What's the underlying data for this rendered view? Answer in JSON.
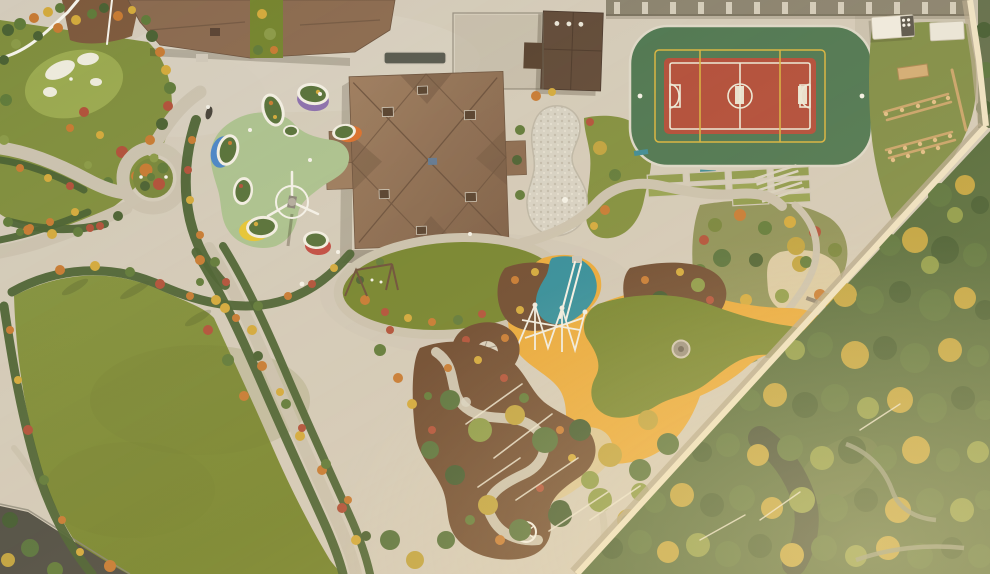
{
  "meta": {
    "domain": "natural-image",
    "title": "Autumn aerial drone view of a landscaped residential estate with playgrounds, sports court, lawns and surrounding pine forest",
    "view": "top-down aerial photograph",
    "season": "autumn"
  },
  "scene": {
    "main_house": "large residence with brown hipped roof, multiple chimneys, skylight and rear bay window",
    "outbuildings": [
      "garage / service wing along the top edge",
      "pool house with dark brown roof beside the sports court"
    ],
    "sports_court": "green multi-sport court with red centre field, white football markings, yellow overlay lines and colonnade wall above",
    "toddler_playground": "sage-green rubber surface with white-rimmed planter islands (purple, orange, blue, yellow, red accents) and a carousel/windmill feature",
    "central_playground": "amber-yellow rubber surface wrapping a kidney-shaped lawn, teal slide zone, white climbing frame, stone fire-pit circle, sand pit with mounds and a teepee tent",
    "landscape": [
      "putting green with white sand bunkers",
      "large oval lawn with clipped hedges",
      "roundabout planting island with round shrubs",
      "dry pebble pond",
      "terraced garden beds",
      "serpentine path through bark-mulch play area",
      "garden steps",
      "wooden obstacle course on grass",
      "diagonal boundary wall",
      "pine and birch forest with autumn colour",
      "dark forest road"
    ],
    "vehicles": [
      "white box truck near top right",
      "white storage container",
      "scooter parked on plaza"
    ],
    "counts": {
      "planter_islands": 8,
      "sand_bunkers": 4,
      "sand_mounds": 4,
      "terrace_beds": 10,
      "colonnade_pillars": 13
    }
  },
  "colors": {
    "paving": "#d3cbbb",
    "paving_dark": "#bcb3a1",
    "road_light": "#cac2b0",
    "road_dark": "#4d4c44",
    "lawn": "#7f8e3e",
    "lawn_dark": "#74842f",
    "lawn_light": "#93a24b",
    "putting_green": "#9cab51",
    "sand_bunker": "#edebdd",
    "roof_main": "#8a6a50",
    "roof_light": "#9b7b5f",
    "roof_dark": "#6b523e",
    "roof_outbuilding": "#5d4737",
    "court_green": "#4a7551",
    "court_red": "#b04a38",
    "court_line_white": "#eceada",
    "court_line_yellow": "#d8b43e",
    "playground_yellow": "#e9a93a",
    "playground_sage": "#abc290",
    "playground_teal": "#2f8d9d",
    "rubber_purple": "#8a6fae",
    "rubber_orange": "#d96f2e",
    "rubber_blue": "#4a86c8",
    "rubber_red": "#c04b44",
    "rubber_yellow": "#e5c535",
    "island_rim": "#f2efe4",
    "mulch": "#6d4a31",
    "mulch_light": "#7d5a3d",
    "sand_play": "#d9c596",
    "gravel": "#d7d3c6",
    "gravel_warm": "#d9caa6",
    "shrub_dark": "#4a6133",
    "shrub_green": "#5f7a3a",
    "shrub_olive": "#74843c",
    "shrub_orange": "#c67a33",
    "shrub_red": "#b0503a",
    "shrub_yellow": "#d2a93c",
    "tree_green": "#55713c",
    "tree_dark": "#3f5930",
    "tree_yellow": "#bfa23e",
    "tree_lime": "#8a9a48",
    "forest_base": "#4f683a",
    "wall": "#eee3c6",
    "wall_shadow": "#b3a88e",
    "white": "#f4f2ea",
    "wood": "#c8a36a",
    "structure_gray": "#9a958a"
  }
}
